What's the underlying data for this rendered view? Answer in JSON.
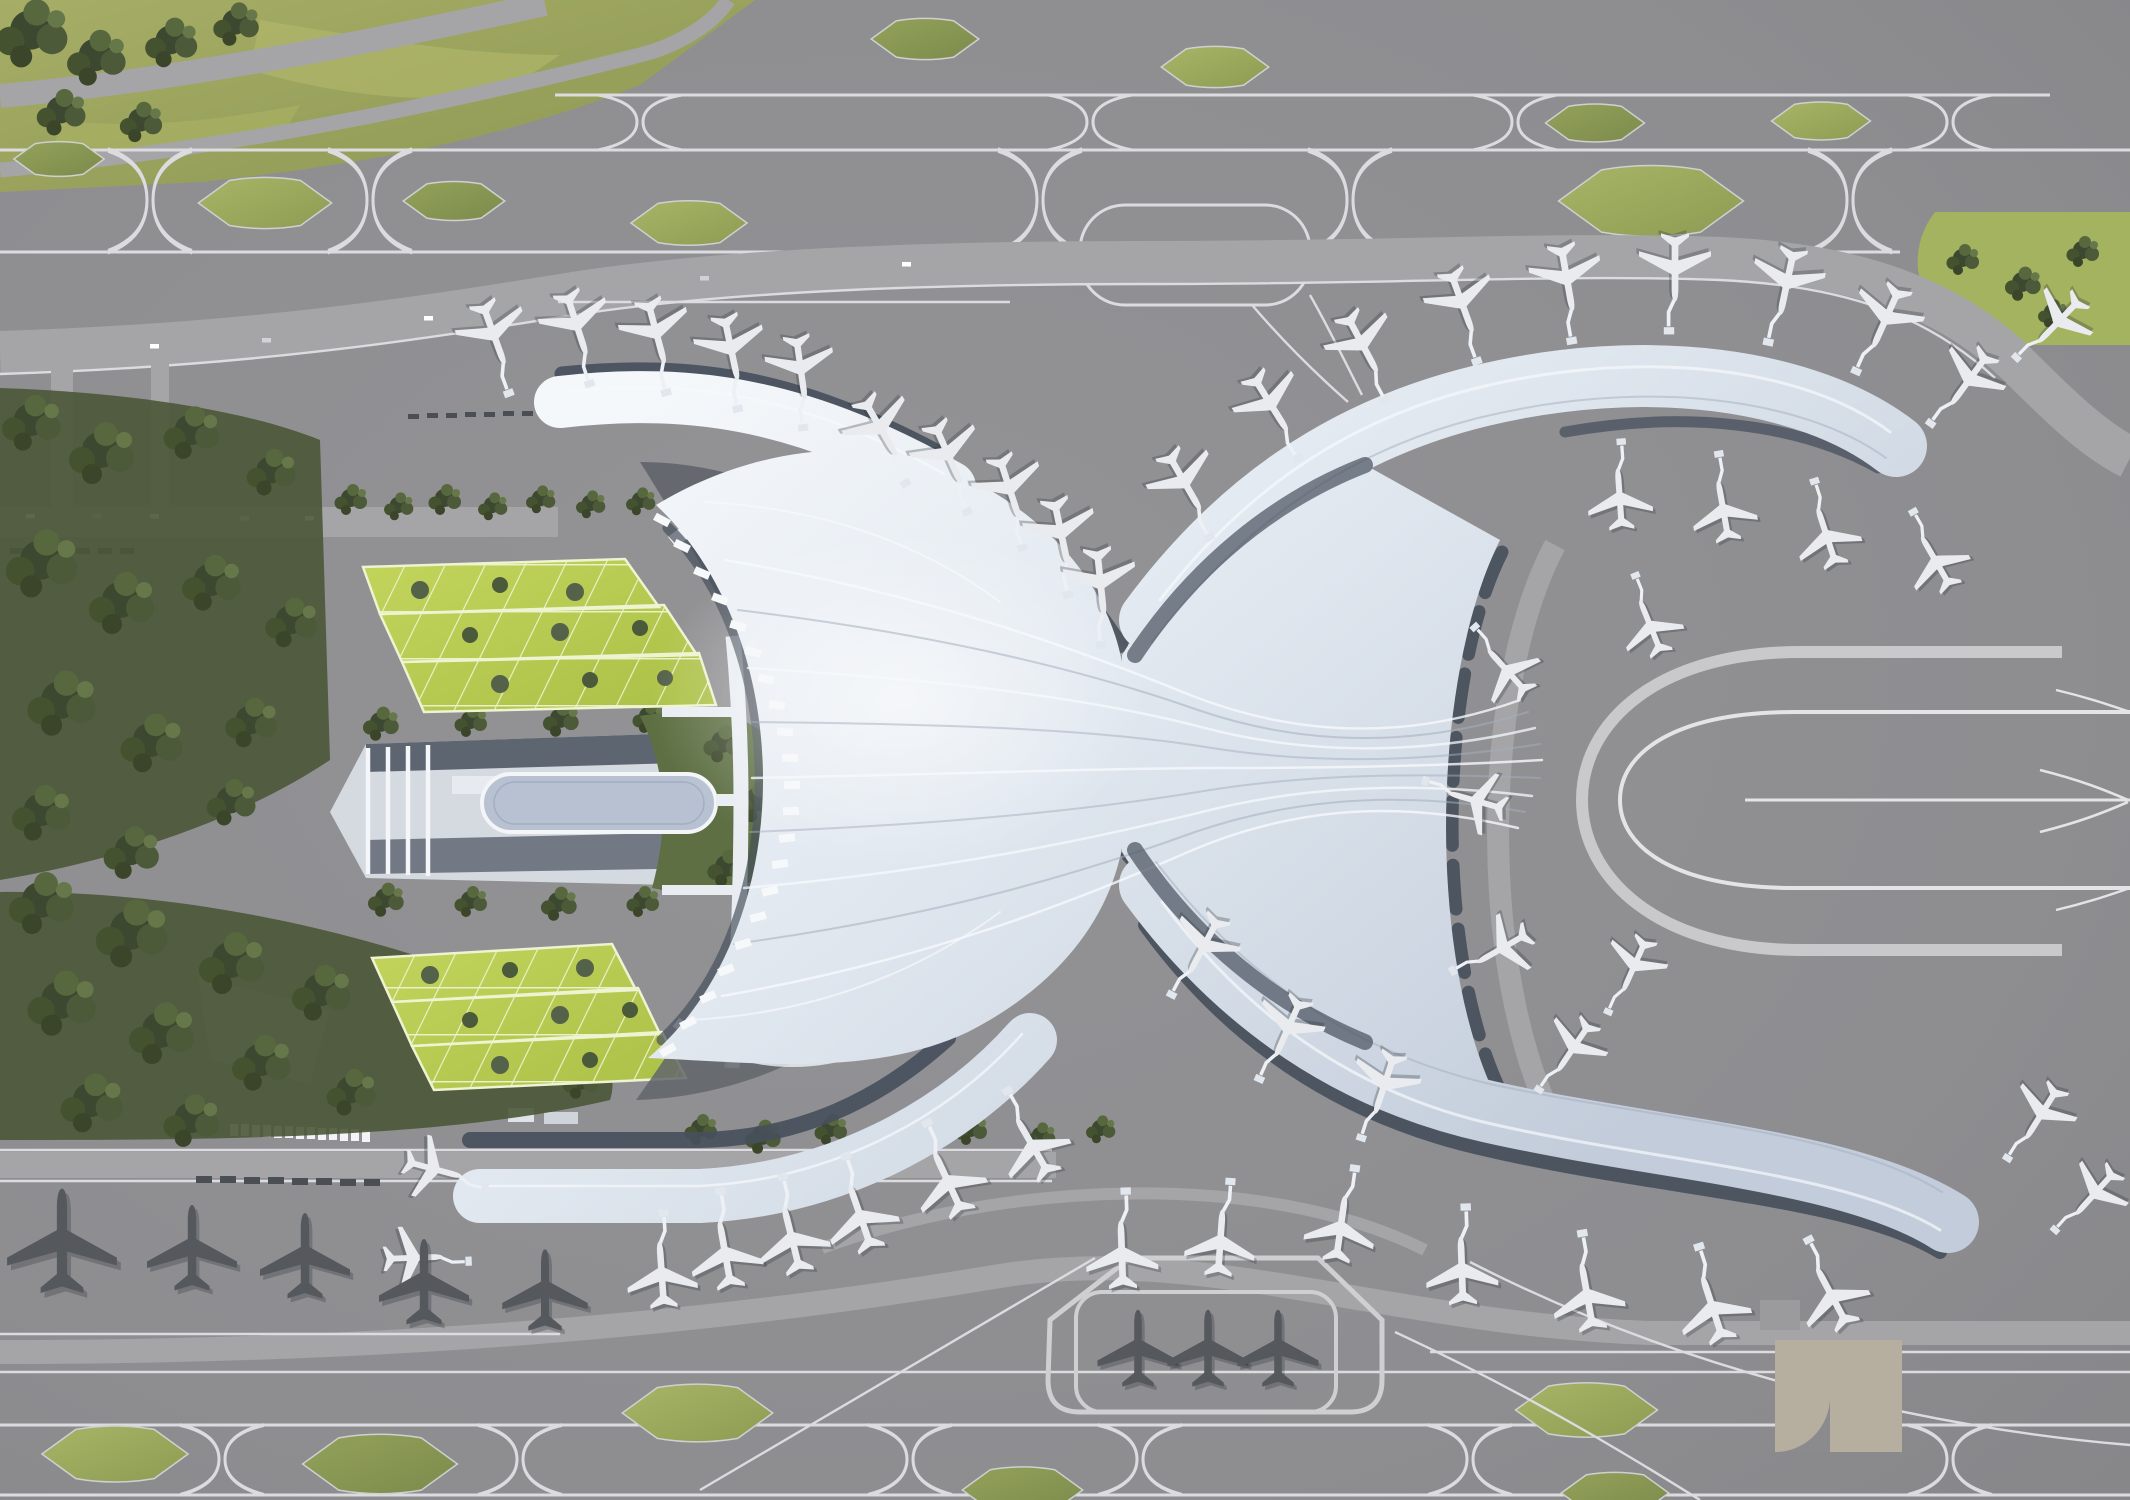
{
  "scene": {
    "title": "Aerial rendering of an airport terminal complex, top-down view",
    "type": "architectural-rendering",
    "terminal": {
      "description": "White flowing-roof terminal shaped like an X with a crescent west entrance",
      "piers": 4,
      "entrance_canopy_modules": 21,
      "roof_style": "curved white shells with flowing ridge lines converging at a central waist"
    },
    "landside": {
      "ground_transport_center": 1,
      "elevated_oval_loop": 1,
      "green_roof_parking_garages": 2,
      "garage_blocks_per_garage": 3,
      "bus_canopy_modules": 13,
      "tree_parks": 2
    },
    "airside": {
      "aircraft_at_contact_gates": 50,
      "aircraft_remote_stands": 5,
      "aircraft_holding_pad": 3,
      "taxiway_infield_lenses": 13,
      "holding_loops": 2,
      "u_turn_taxi_loops": 2,
      "holding_pads": 1
    }
  },
  "palette": {
    "apron": "#8e8e91",
    "road": "#a5a5a7",
    "taxi-line": "#dcdce0",
    "slate": "#47505c",
    "roof-hi": "#f4f7fa",
    "roof-lo": "#c2ccda",
    "grass": "#9aa35f",
    "grass-bright": "#bACB52",
    "tree-dark": "#3b4730",
    "tree-mid": "#5a6a42",
    "plane-light": "#e9ebee",
    "plane-dark": "#55585c",
    "bridge": "#edf0f4",
    "oval": "#b7c1d1",
    "tan": "#b6afa0"
  }
}
